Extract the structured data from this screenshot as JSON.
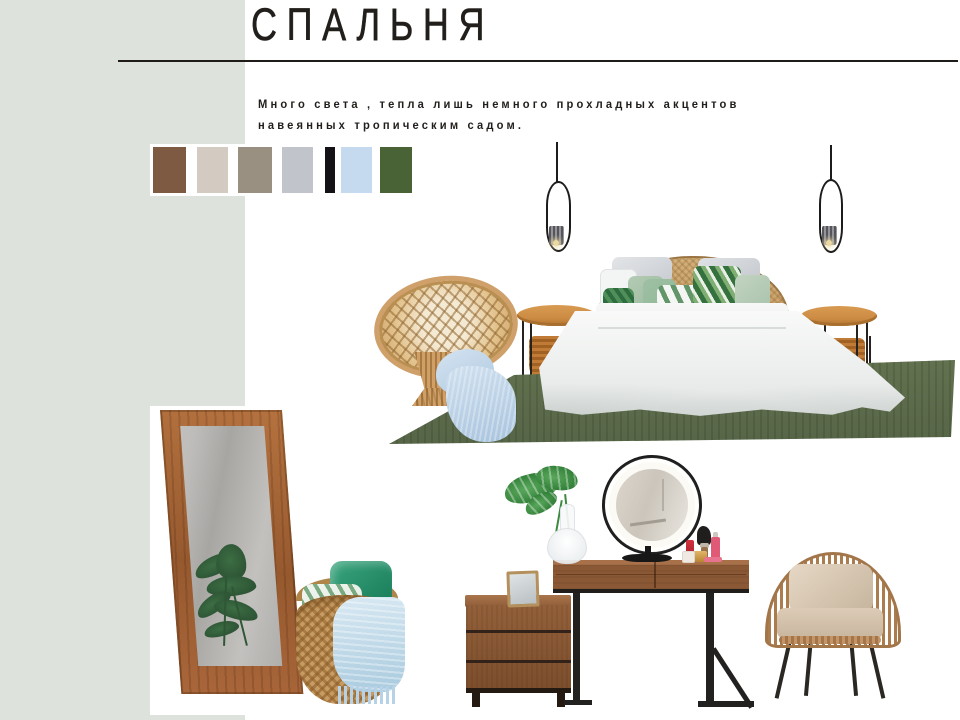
{
  "header": {
    "title": "СПАЛЬНЯ"
  },
  "description": {
    "line1": "Много света , тепла  лишь немного прохладных акцентов",
    "line2": "навеянных тропическим садом."
  },
  "palette": {
    "swatches": [
      {
        "name": "brown",
        "hex": "#7d5a41",
        "x": 3,
        "w": 33
      },
      {
        "name": "warm-beige",
        "hex": "#d3cac2",
        "x": 47,
        "w": 31
      },
      {
        "name": "taupe",
        "hex": "#9a9081",
        "x": 88,
        "w": 34
      },
      {
        "name": "silver-gray",
        "hex": "#c1c4cb",
        "x": 132,
        "w": 31
      },
      {
        "name": "black",
        "hex": "#141216",
        "x": 175,
        "w": 10
      },
      {
        "name": "light-blue",
        "hex": "#c5daee",
        "x": 191,
        "w": 31
      },
      {
        "name": "forest-green",
        "hex": "#4a6336",
        "x": 230,
        "w": 32
      }
    ]
  },
  "colors": {
    "sidebar": "#dde2dd",
    "rule": "#1e1b18",
    "text": "#221e1b",
    "rug_green": "#5e6e4d",
    "walnut": "#8a5835",
    "table_wood": "#cd8c44",
    "rattan": "#c89a62",
    "mirror_frame": "#a9663a",
    "throw_blue": "#a9c4de",
    "metal_black": "#1f1d1b",
    "basket": "#c79c62",
    "cushion_beige": "#c8b59e",
    "pillow_green": "#8fb996"
  }
}
